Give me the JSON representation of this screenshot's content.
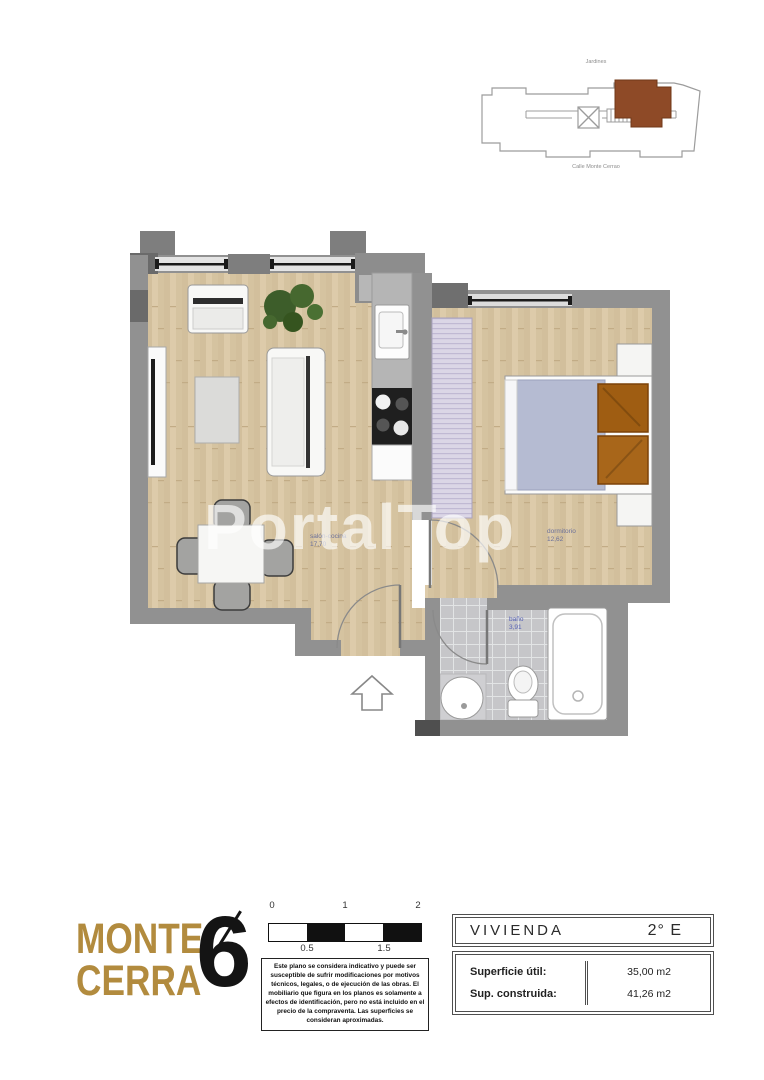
{
  "watermark": {
    "text": "PortalTop"
  },
  "site_plan": {
    "top_label": "Jardines",
    "bottom_label": "Calle Monte Cerrao",
    "highlight_color": "#8e4a27"
  },
  "floor_plan": {
    "rooms": [
      {
        "name": "salón-cocina",
        "area": "17,70"
      },
      {
        "name": "dormitorio",
        "area": "12,62"
      },
      {
        "name": "baño",
        "area": "3,91"
      }
    ]
  },
  "logo": {
    "word1": "MONTE",
    "word2": "CERRA",
    "number": "6",
    "gold": "#b28b3e"
  },
  "scale_bar": {
    "labels_top": [
      "0",
      "1",
      "2"
    ],
    "labels_bottom": [
      "0.5",
      "1.5"
    ]
  },
  "disclaimer": {
    "text": "Este plano se considera indicativo y puede ser susceptible de sufrir modificaciones por motivos técnicos, legales, o de ejecución de las obras. El mobiliario que figura en los planos es solamente a efectos de identificación, pero no está incluido en el precio de la compraventa. Las superficies se consideran aproximadas."
  },
  "info_table": {
    "title": "VIVIENDA",
    "unit": "2° E",
    "rows": [
      {
        "label": "Superficie útil:",
        "value": "35,00 m2"
      },
      {
        "label": "Sup. construida:",
        "value": "41,26 m2"
      }
    ]
  }
}
